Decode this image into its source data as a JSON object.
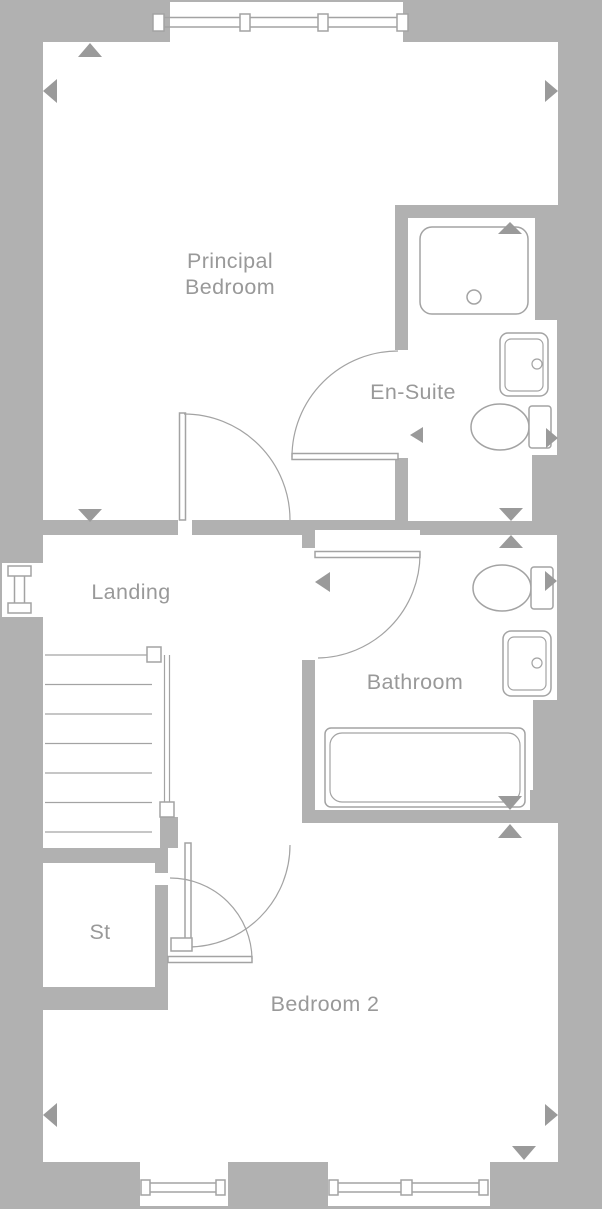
{
  "palette": {
    "bg": "#b1b1b1",
    "room-fill": "#ffffff",
    "line-color": "#a3a3a3",
    "marker-color": "#9a9a9a",
    "text-color": "#999999"
  },
  "plan": {
    "type": "floor-plan",
    "rooms": {
      "principal_bedroom": {
        "label_line_1": "Principal",
        "label_line_2": "Bedroom"
      },
      "en_suite": {
        "label": "En-Suite"
      },
      "landing": {
        "label": "Landing"
      },
      "bathroom": {
        "label": "Bathroom"
      },
      "storage": {
        "label": "St"
      },
      "bedroom_2": {
        "label": "Bedroom 2"
      }
    },
    "fixtures": [
      "shower-tray",
      "washbasin-en-suite",
      "toilet-en-suite",
      "toilet-bathroom",
      "washbasin-bathroom",
      "bathtub",
      "staircase-with-handrail"
    ],
    "openings": [
      "window-top",
      "window-left-landing",
      "window-bottom-left",
      "window-bottom-right",
      "door-principal-bedroom",
      "door-en-suite",
      "door-bathroom",
      "door-bedroom-2",
      "door-storage"
    ],
    "dimension_markers": "triangular arrows at measurement points"
  }
}
